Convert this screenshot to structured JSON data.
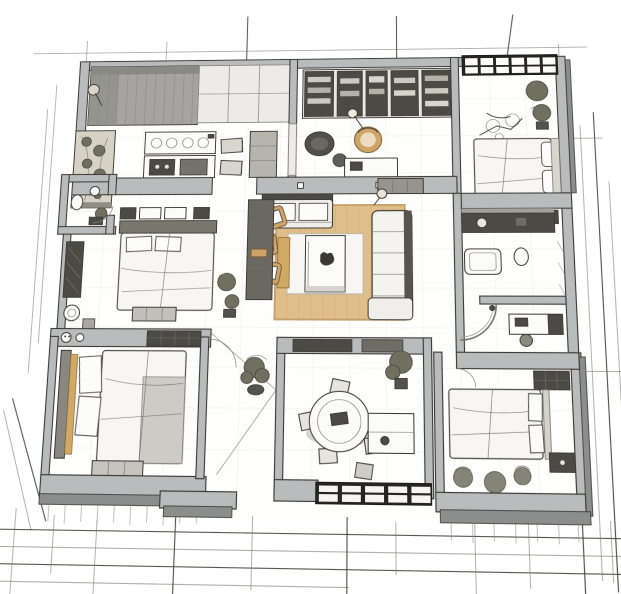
{
  "meta": {
    "type": "architectural-floor-plan-sketch",
    "view": "top-down-perspective",
    "style": "hand-drawn-pencil-with-wood-accents"
  },
  "palette": {
    "paper": "#ffffff",
    "ink": "#3d3a35",
    "wall_top": "#b9bcbc",
    "wall_side": "#8b8e8d",
    "fixture_dark": "#4c4a45",
    "mullion": "#26251f",
    "wood": "#dfbe8a",
    "wood_edge": "#c7a169",
    "tan_chair": "#cfa469",
    "duvet": "#f7f6f3",
    "blanket": "#c9c8c3",
    "plant": "#6f705f",
    "pot": "#54524d",
    "shadow": "#b6b4af",
    "curtain": "#a5a4a0"
  },
  "rooms": [
    {
      "name": "kitchen",
      "furniture": [
        "curtain-wall",
        "glass-partition",
        "floor-lamp",
        "planter-console",
        "counter-with-sink",
        "cooking-island",
        "tall-cabinet",
        "bar-stools"
      ]
    },
    {
      "name": "study-library",
      "furniture": [
        "bookshelves",
        "lounge-armchair",
        "round-wicker-chair",
        "floor-lamp",
        "writing-desk",
        "dresser"
      ]
    },
    {
      "name": "bedroom-northeast",
      "furniture": [
        "panoramic-window",
        "double-bed",
        "pillows",
        "shrub-plants",
        "exercise-gear",
        "nightstand"
      ]
    },
    {
      "name": "living-room",
      "furniture": [
        "wood-rug",
        "white-rug",
        "coffee-table",
        "cat-figure",
        "loveseat-sofa",
        "sectional-sofa",
        "tan-armchair",
        "tan-armchair",
        "tan-armchair",
        "wood-bench",
        "floor-lamp"
      ]
    },
    {
      "name": "bedroom-west",
      "furniture": [
        "headboard",
        "double-bed",
        "pillows",
        "wall-cabinets",
        "nightstands",
        "wardrobe-closet",
        "plants",
        "dresser"
      ]
    },
    {
      "name": "bathroom-west",
      "furniture": [
        "toilet",
        "sink",
        "plant",
        "shelf"
      ]
    },
    {
      "name": "hall-closet",
      "furniture": [
        "wardrobe",
        "washer"
      ]
    },
    {
      "name": "bedroom-southwest",
      "furniture": [
        "headboard",
        "wood-rail",
        "double-bed",
        "pillows",
        "blanket",
        "wall-shelf",
        "dresser",
        "washer-decor"
      ]
    },
    {
      "name": "corridor",
      "furniture": [
        "potted-plant",
        "entrance-step"
      ]
    },
    {
      "name": "dining-room",
      "furniture": [
        "round-table",
        "dining-chairs",
        "stool",
        "sideboard",
        "potted-plant",
        "window-wall",
        "shelf-band"
      ]
    },
    {
      "name": "bathroom-east",
      "furniture": [
        "vanity-counter",
        "mirror",
        "sink",
        "bathtub",
        "toilet",
        "shower-enclosure",
        "desk",
        "desk-chair",
        "cabinet"
      ]
    },
    {
      "name": "bedroom-southeast",
      "furniture": [
        "double-bed",
        "pillows",
        "nightstand",
        "wall-shelf",
        "floor-plants"
      ]
    }
  ],
  "drafting": {
    "construction_lines": true,
    "dimension_ticks": true,
    "door_swing_arcs": true,
    "floor_grid": true
  }
}
